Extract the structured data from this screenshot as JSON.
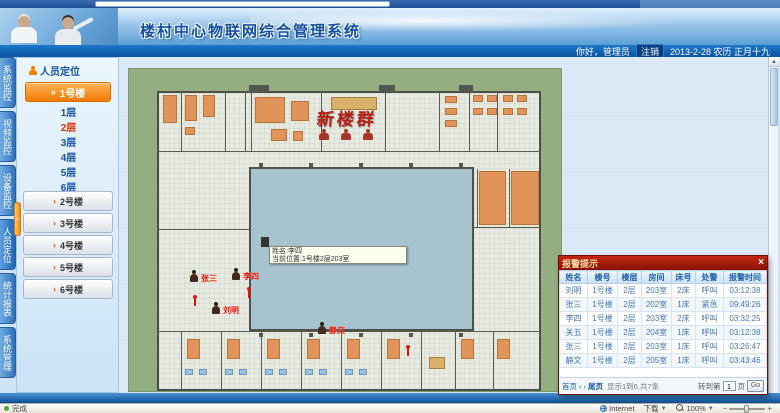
{
  "header": {
    "title": "楼村中心物联网综合管理系统",
    "welcome": "你好，管理员",
    "logout_label": "注销",
    "date_text": "2013-2-28 农历 正月十九"
  },
  "sidebar": {
    "tabs": [
      {
        "label": "系统监控"
      },
      {
        "label": "视频监控"
      },
      {
        "label": "设备监控"
      },
      {
        "label": "人员定位"
      },
      {
        "label": "统计报表"
      },
      {
        "label": "系统管理"
      }
    ],
    "panel_title": "人员定位",
    "active_building": "1号楼",
    "floors": [
      "1层",
      "2层",
      "3层",
      "4层",
      "5层",
      "6层"
    ],
    "active_floor": "2层",
    "buildings": [
      "2号楼",
      "3号楼",
      "4号楼",
      "5号楼",
      "6号楼"
    ],
    "handle_glyph": "‹"
  },
  "map": {
    "plan_label": "新楼群",
    "tooltip": {
      "line1": "姓名:李四",
      "line2": "当前位置:1号楼2层203室"
    },
    "markers": [
      {
        "name": "张三"
      },
      {
        "name": "李四"
      },
      {
        "name": "刘明"
      },
      {
        "name": "静文"
      }
    ]
  },
  "alarm_panel": {
    "title": "报警提示",
    "close_label": "×",
    "columns": [
      "姓名",
      "楼号",
      "楼层",
      "房间",
      "床号",
      "处警",
      "报警时间"
    ],
    "rows": [
      [
        "刘明",
        "1号楼",
        "2层",
        "203室",
        "2床",
        "呼叫",
        "03:12:38"
      ],
      [
        "张三",
        "1号楼",
        "2层",
        "202室",
        "1床",
        "紧急",
        "09:49:26"
      ],
      [
        "李四",
        "1号楼",
        "2层",
        "203室",
        "2床",
        "呼叫",
        "03:32:25"
      ],
      [
        "关五",
        "1号楼",
        "2层",
        "204室",
        "1床",
        "呼叫",
        "03:12:38"
      ],
      [
        "张三",
        "1号楼",
        "2层",
        "203室",
        "1床",
        "呼叫",
        "03:26:47"
      ],
      [
        "静文",
        "1号楼",
        "2层",
        "205室",
        "1床",
        "呼叫",
        "03:43:46"
      ]
    ],
    "pagination": {
      "first": "首页",
      "prev": "‹",
      "next": "›",
      "last": "尾页",
      "info": "显示1到6,共7条",
      "goto_label": "转到第",
      "page_value": "1",
      "page_suffix": "页",
      "go": "Go"
    }
  },
  "statusbar": {
    "left": "完成",
    "internet": "Internet",
    "download": "下载",
    "zoom": "100%",
    "minus": "−",
    "plus": "+"
  },
  "scrollbar": {
    "up_arrow": "▲"
  },
  "colors": {
    "accent_orange": "#f07b00",
    "alarm_red": "#8a1408",
    "header_blue": "#0c54a2",
    "plan_green": "#93ae80",
    "courtyard_blue": "#a7c3ce"
  }
}
